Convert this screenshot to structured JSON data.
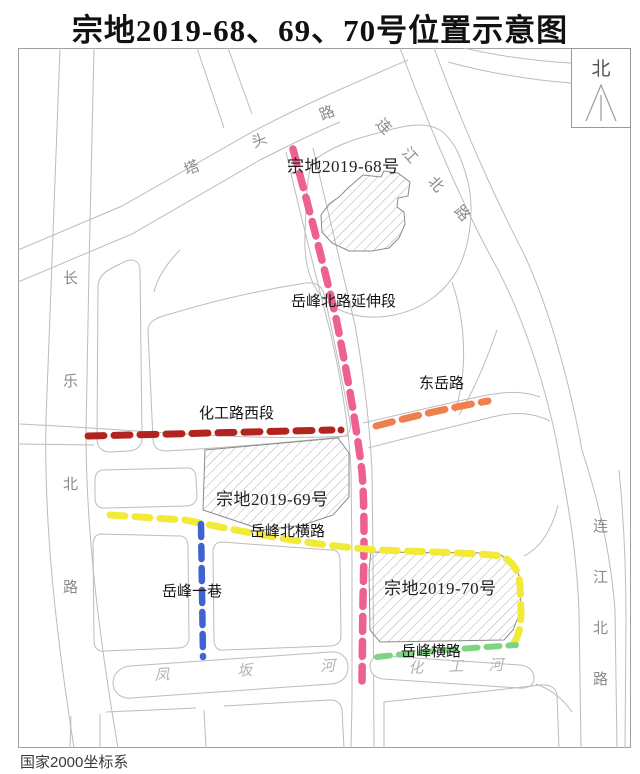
{
  "title": "宗地2019-68、69、70号位置示意图",
  "north": {
    "label": "北"
  },
  "footer": {
    "coordinate_system": "国家2000坐标系"
  },
  "parcels": {
    "p68": {
      "label": "宗地2019-68号"
    },
    "p69": {
      "label": "宗地2019-69号"
    },
    "p70": {
      "label": "宗地2019-70号"
    }
  },
  "planned_roads": {
    "yuefeng_north_ext": {
      "label": "岳峰北路延伸段",
      "color": "#ee5f92"
    },
    "huagong_west": {
      "label": "化工路西段",
      "color": "#b22420"
    },
    "dongyue": {
      "label": "东岳路",
      "color": "#ef7f4e"
    },
    "yuefeng_north_cross": {
      "label": "岳峰北横路",
      "color": "#f2ea38"
    },
    "yuefeng_lane1": {
      "label": "岳峰一巷",
      "color": "#3f63d0"
    },
    "yuefeng_cross": {
      "label": "岳峰横路",
      "color": "#7ed482"
    }
  },
  "existing_roads": {
    "tatou": {
      "label": "塔头路"
    },
    "changle_north": {
      "label": "长乐北路"
    },
    "lianjiang_north_top": {
      "label": "连江北路"
    },
    "lianjiang_north_right": {
      "label": "连江北路"
    }
  },
  "rivers": {
    "fengban": {
      "label": "凤坂河"
    },
    "huagong": {
      "label": "化工河"
    }
  }
}
